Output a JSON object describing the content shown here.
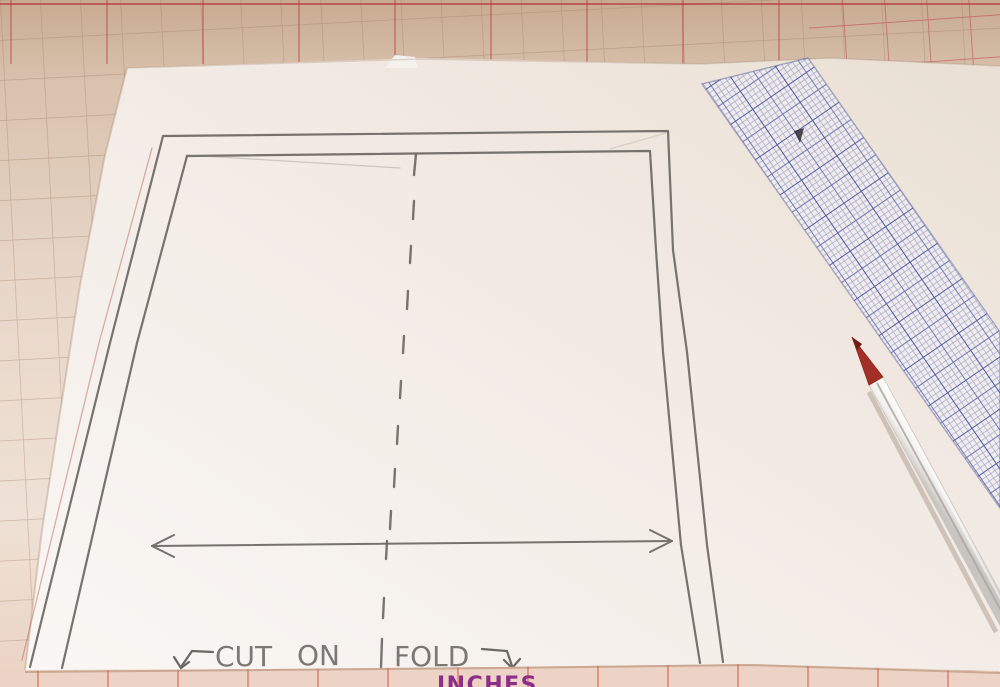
{
  "annotations": {
    "cut": "CUT",
    "on": "ON",
    "fold": "FOLD"
  },
  "mat": {
    "inches_label": "INCHES"
  },
  "colors": {
    "mat_tan": "#c7ab90",
    "mat_grid_line": "#9e785c",
    "mat_red": "#be2837",
    "mat_bottom_pink": "#ecd3c5",
    "paper_white": "#f4eee9",
    "graphite_gray": "#6b6763",
    "ruler_blue": "#37479c",
    "pencil_tip_red": "#a33028",
    "pencil_shaft_white": "#f1efec",
    "inches_purple": "#8d2d8a"
  }
}
